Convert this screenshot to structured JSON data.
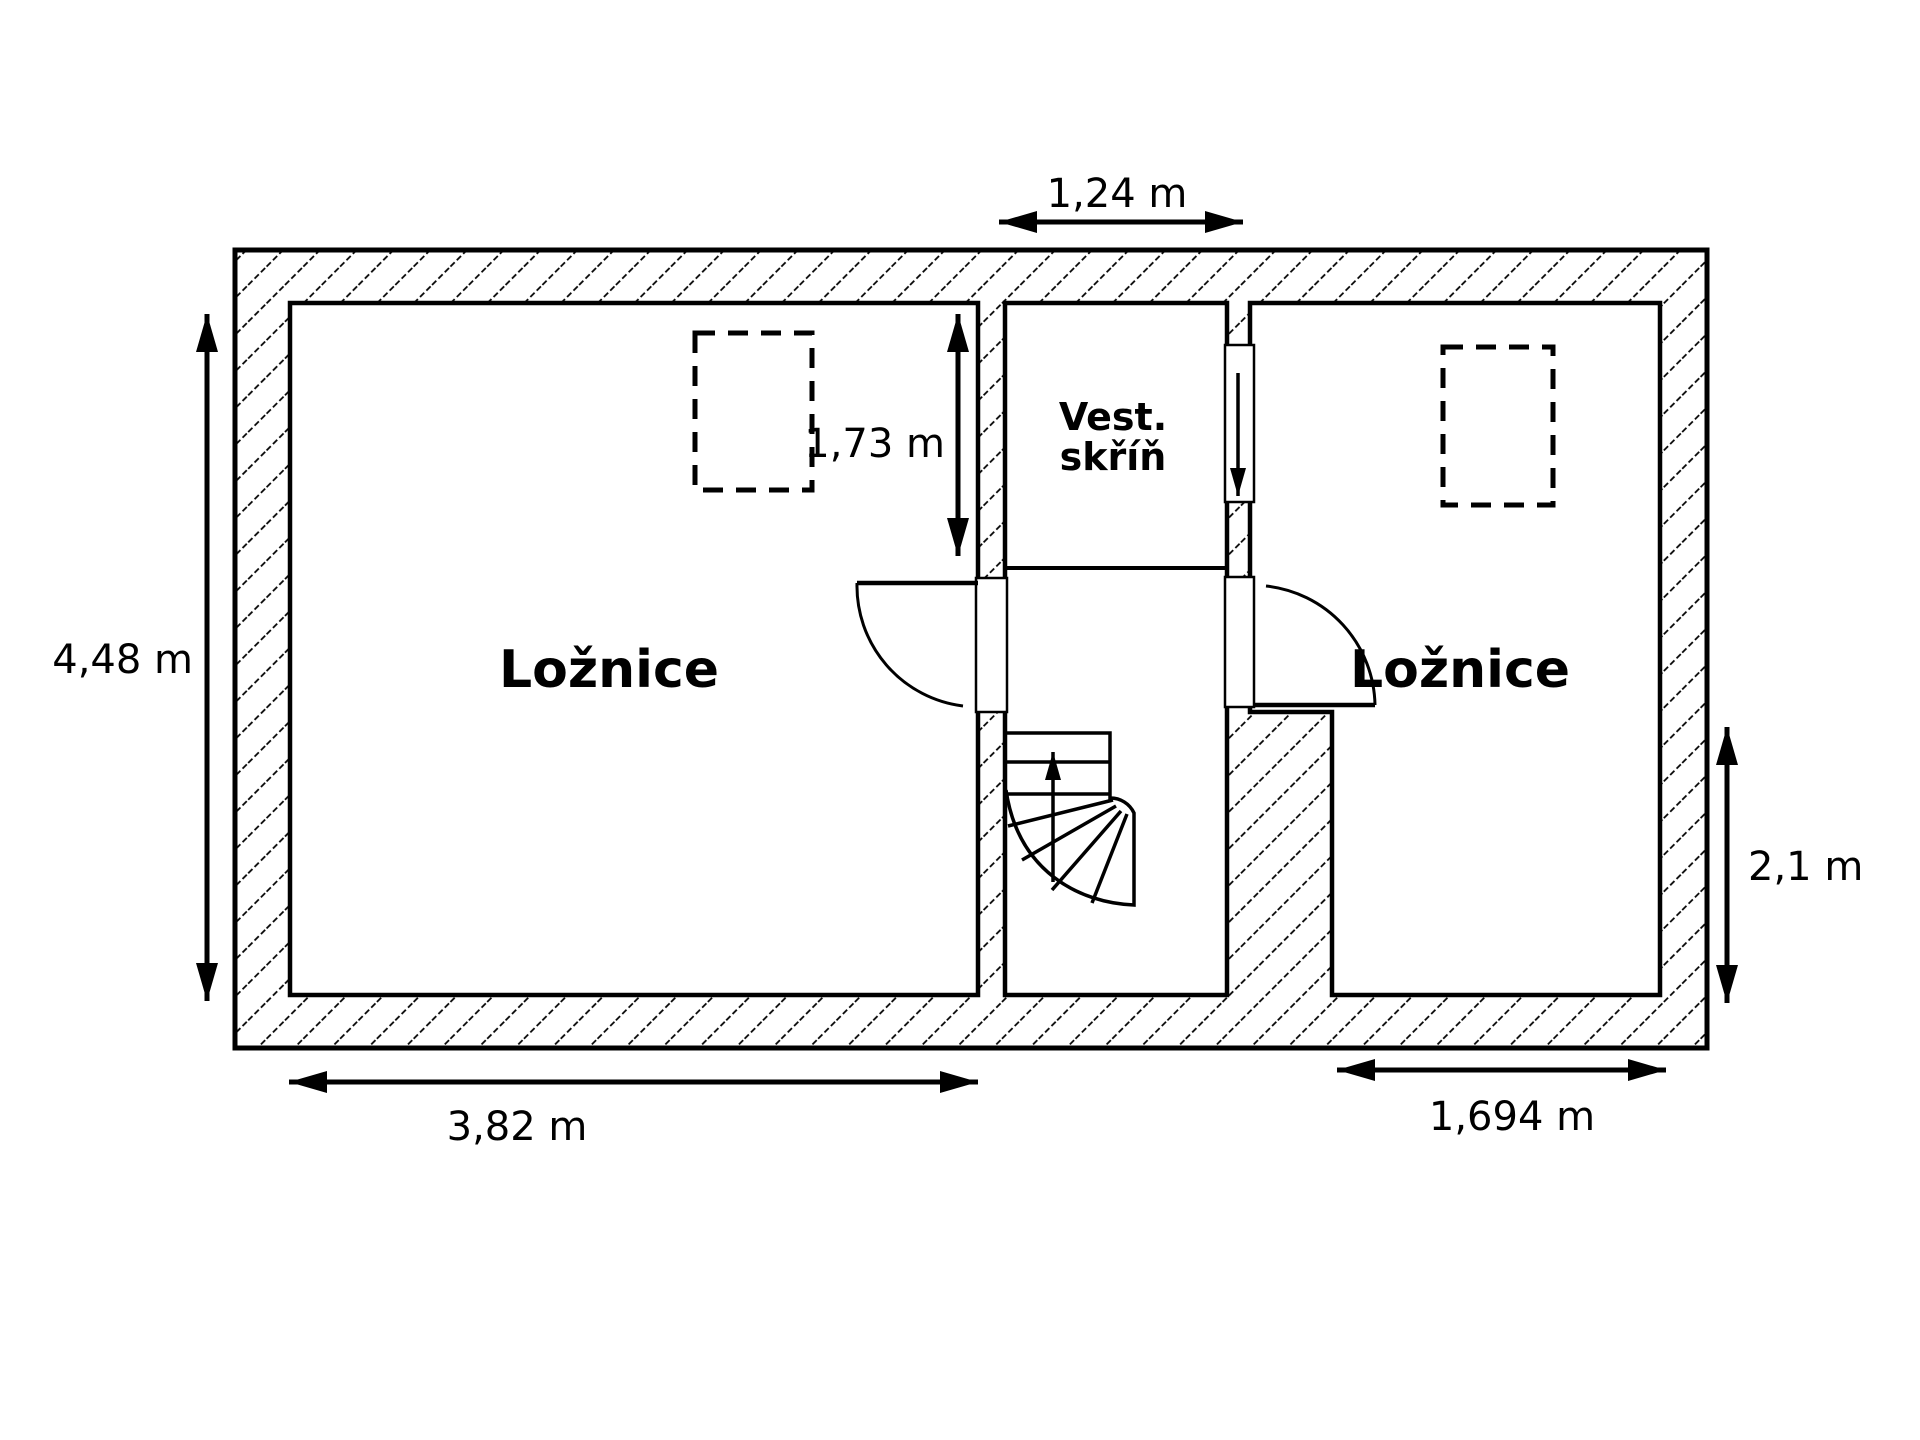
{
  "drawing": {
    "rooms": {
      "bedroom_left_label": "Ložnice",
      "bedroom_right_label": "Ložnice",
      "closet_label_line1": "Vest.",
      "closet_label_line2": "skříň"
    },
    "dimensions": {
      "closet_width": "1,24 m",
      "closet_depth": "1,73 m",
      "left_room_height": "4,48 m",
      "left_room_width": "3,82 m",
      "right_room_width": "1,694 m",
      "right_room_height": "2,1 m"
    },
    "icons": {
      "stairs_direction": "up-arrow",
      "closet_opening": "down-arrow"
    },
    "colors": {
      "line": "#000000",
      "background": "#ffffff"
    }
  }
}
